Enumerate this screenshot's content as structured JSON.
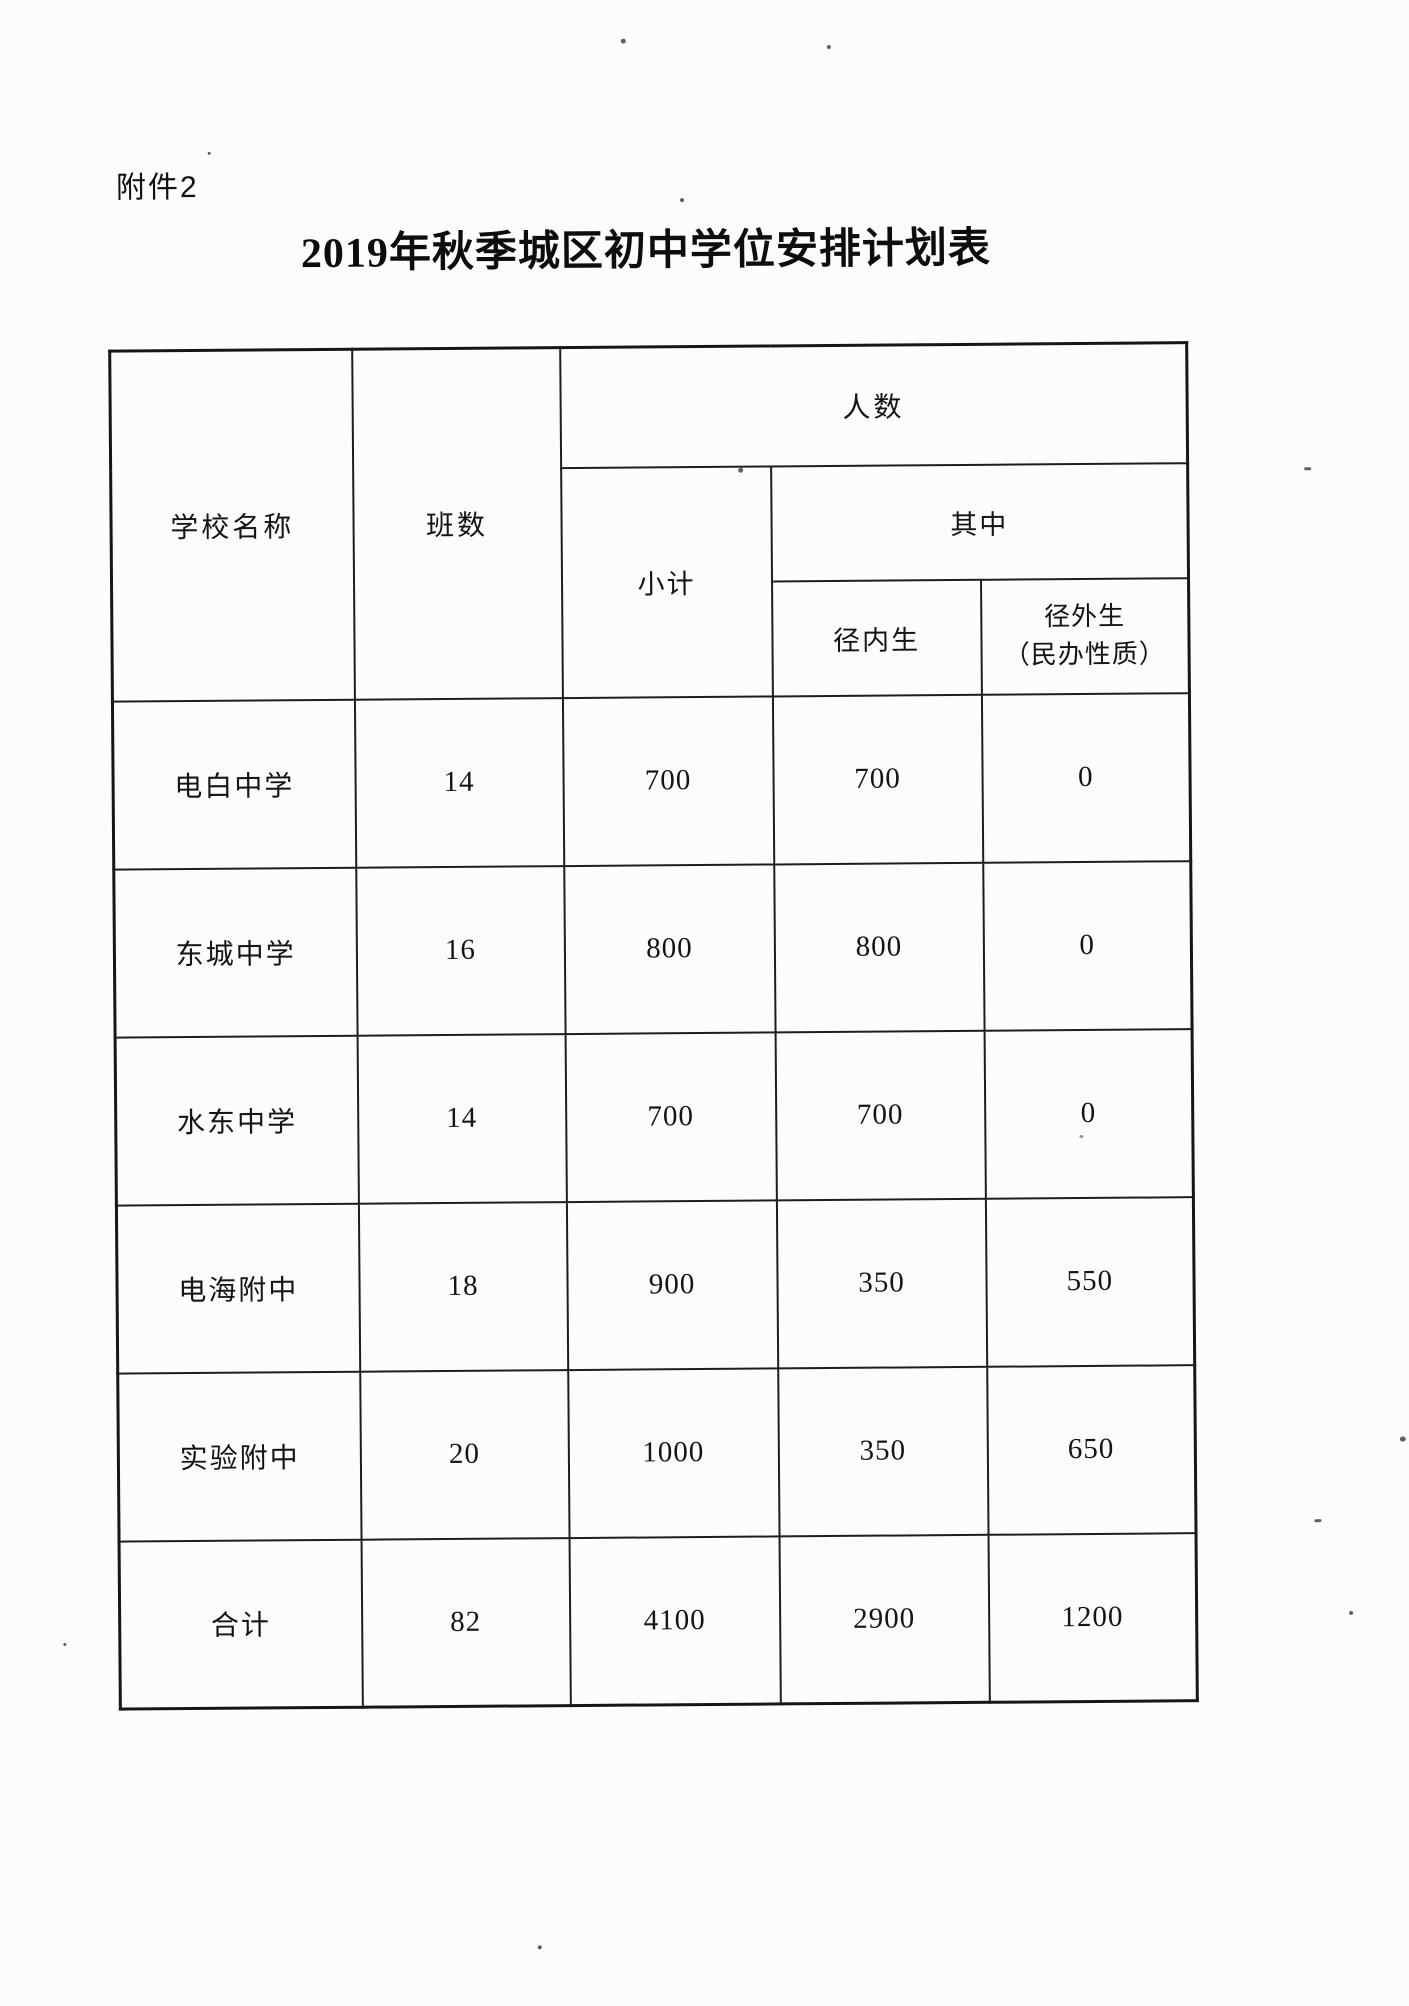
{
  "page": {
    "attachment_label": "附件2",
    "title": "2019年秋季城区初中学位安排计划表"
  },
  "table": {
    "headers": {
      "school_name": "学校名称",
      "class_count": "班数",
      "people_count": "人数",
      "subtotal": "小计",
      "of_which": "其中",
      "in_district": "径内生",
      "out_district_line1": "径外生",
      "out_district_line2": "（民办性质）"
    },
    "rows": [
      {
        "school": "电白中学",
        "classes": "14",
        "subtotal": "700",
        "in_district": "700",
        "out_district": "0"
      },
      {
        "school": "东城中学",
        "classes": "16",
        "subtotal": "800",
        "in_district": "800",
        "out_district": "0"
      },
      {
        "school": "水东中学",
        "classes": "14",
        "subtotal": "700",
        "in_district": "700",
        "out_district": "0"
      },
      {
        "school": "电海附中",
        "classes": "18",
        "subtotal": "900",
        "in_district": "350",
        "out_district": "550"
      },
      {
        "school": "实验附中",
        "classes": "20",
        "subtotal": "1000",
        "in_district": "350",
        "out_district": "650"
      },
      {
        "school": "合计",
        "classes": "82",
        "subtotal": "4100",
        "in_district": "2900",
        "out_district": "1200"
      }
    ]
  }
}
